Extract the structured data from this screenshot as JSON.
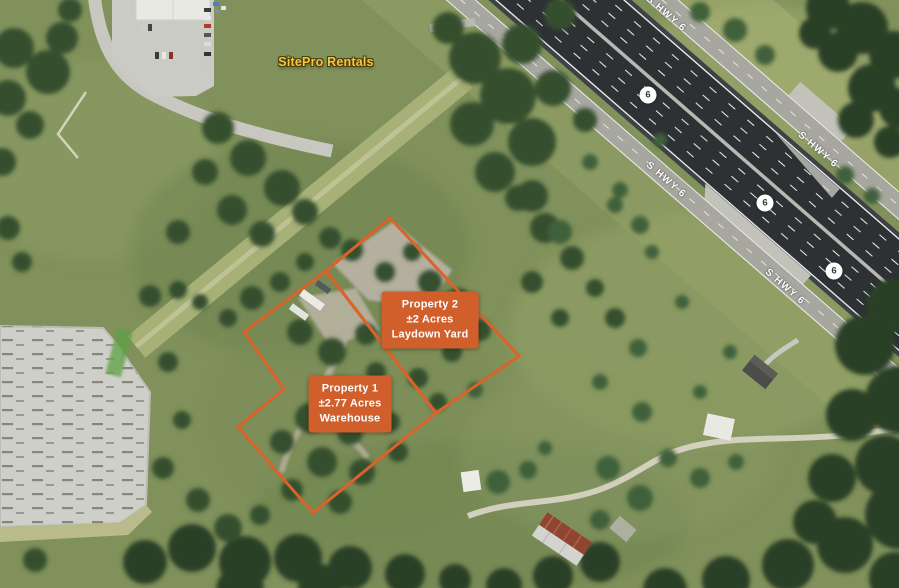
{
  "map": {
    "business_label": "SitePro Rentals",
    "highway": {
      "name": "S HWY 6",
      "shield": "6"
    },
    "properties": [
      {
        "name": "Property 1",
        "acres": "±2.77 Acres",
        "use": "Warehouse"
      },
      {
        "name": "Property 2",
        "acres": "±2 Acres",
        "use": "Laydown Yard"
      }
    ],
    "colors": {
      "parcel_outline": "#DB6228",
      "parcel_label_bg": "#D15F2C",
      "business_label_text": "#F2C83C",
      "highway_label_text": "#FFFFFF"
    }
  }
}
